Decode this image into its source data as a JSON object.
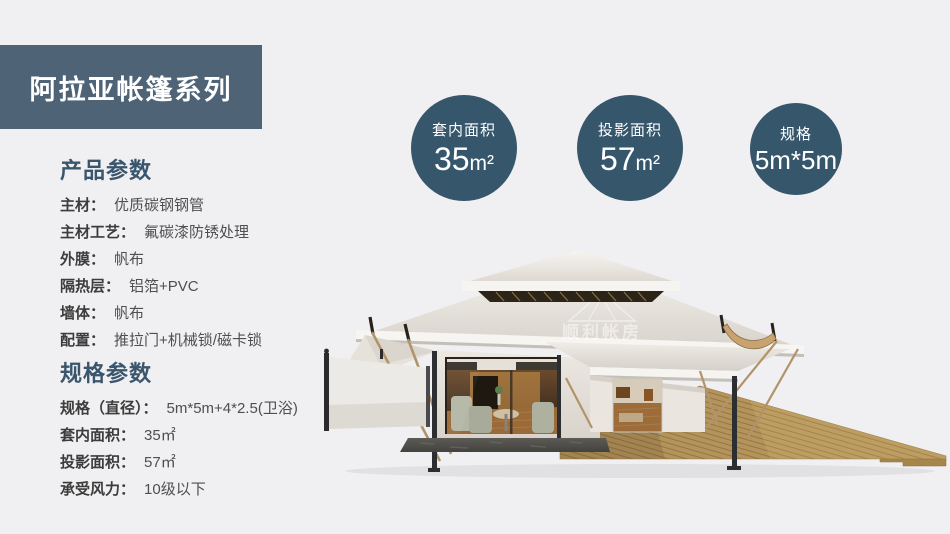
{
  "page": {
    "background": "#f0eff1"
  },
  "banner": {
    "title": "阿拉亚帐篷系列",
    "bg": "#4e6376",
    "text_color": "#ffffff"
  },
  "product_params": {
    "heading": "产品参数",
    "items": [
      {
        "label": "主材：",
        "value": "优质碳钢钢管"
      },
      {
        "label": "主材工艺：",
        "value": "氟碳漆防锈处理"
      },
      {
        "label": "外膜：",
        "value": "帆布"
      },
      {
        "label": "隔热层：",
        "value": "铝箔+PVC"
      },
      {
        "label": "墙体：",
        "value": "帆布"
      },
      {
        "label": "配置：",
        "value": "推拉门+机械锁/磁卡锁"
      }
    ]
  },
  "spec_params": {
    "heading": "规格参数",
    "items": [
      {
        "label": "规格（直径）：",
        "value": "5m*5m+4*2.5(卫浴)"
      },
      {
        "label": "套内面积：",
        "value": "35㎡"
      },
      {
        "label": "投影面积：",
        "value": "57㎡"
      },
      {
        "label": "承受风力：",
        "value": "10级以下"
      }
    ]
  },
  "badges": [
    {
      "label": "套内面积",
      "value": "35",
      "unit": "m²"
    },
    {
      "label": "投影面积",
      "value": "57",
      "unit": "m²"
    },
    {
      "label": "规格",
      "value": "5m*5m",
      "unit": ""
    }
  ],
  "badge_color": "#36566c",
  "heading_color": "#3a566d",
  "watermark": {
    "cn": "顺利帐房",
    "en": "WELL TENT"
  }
}
